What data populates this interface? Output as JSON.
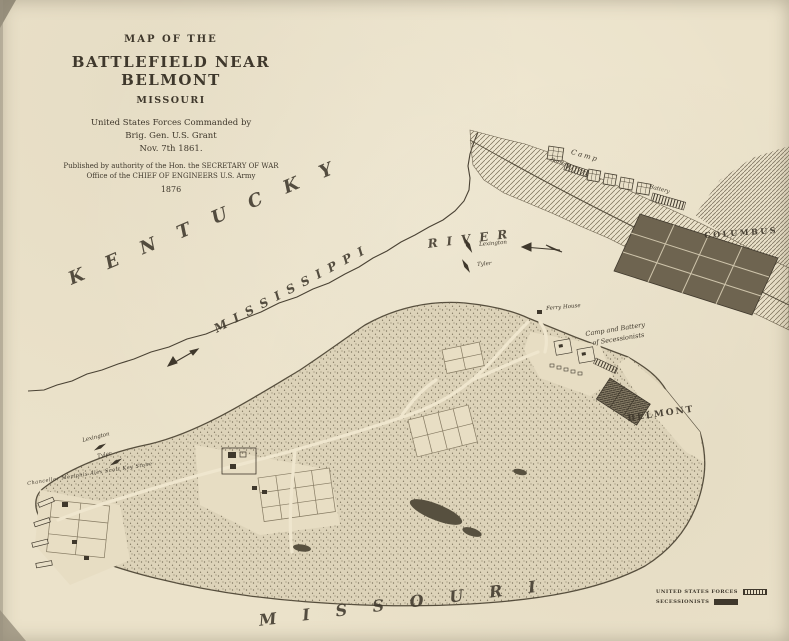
{
  "title_block": {
    "l1": "MAP OF THE",
    "l2": "BATTLEFIELD NEAR BELMONT",
    "l3": "MISSOURI",
    "l4": "United States Forces Commanded by",
    "l5": "Brig. Gen. U.S. Grant",
    "l6": "Nov. 7th 1861.",
    "l7": "Published by authority of the Hon. the SECRETARY OF WAR",
    "l8": "Office of the CHIEF OF ENGINEERS U.S. Army",
    "l9": "1876"
  },
  "regions": {
    "kentucky": "KENTUCKY",
    "mississippi": "MISSISSIPPI",
    "river": "RIVER",
    "missouri": "MISSOURI"
  },
  "places": {
    "columbus": "COLUMBUS",
    "belmont": "BELMONT",
    "camp": "Camp",
    "battery": "Battery",
    "ferry_house": "Ferry House",
    "camp_battery_line1": "Camp and Battery",
    "camp_battery_line2": "of Secessionists"
  },
  "vessels": {
    "gunboat_lexington": "Lexington",
    "gunboat_tyler": "Tyler",
    "transports": "Chancellor  Memphis  Alex Scott  Key Stone"
  },
  "legend": {
    "us_label": "UNITED STATES FORCES",
    "cs_label": "SECESSIONISTS"
  },
  "colors": {
    "paper": "#ebe2ca",
    "ink": "#3f382c",
    "woods": "#ddd3b9",
    "clearing": "#e7ddc3"
  }
}
